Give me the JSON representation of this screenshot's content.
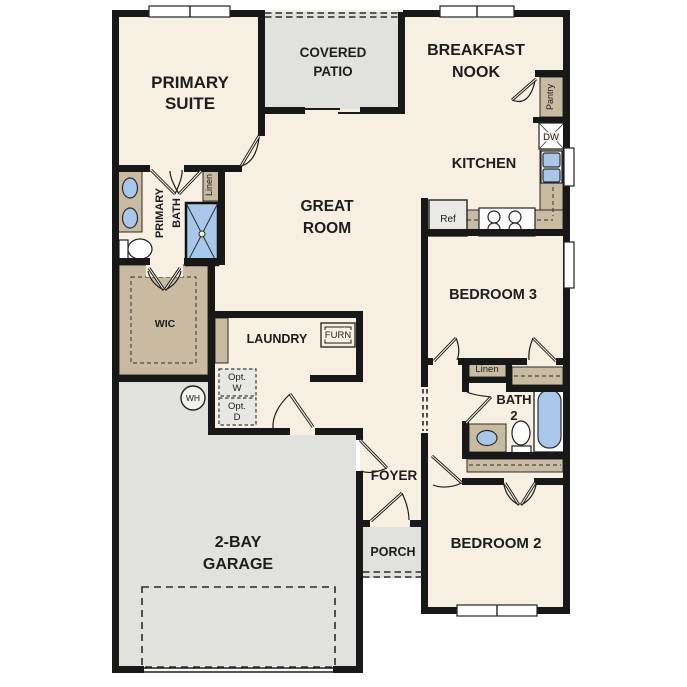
{
  "rooms": {
    "primary_suite": {
      "line1": "PRIMARY",
      "line2": "SUITE"
    },
    "covered_patio": {
      "line1": "COVERED",
      "line2": "PATIO"
    },
    "breakfast_nook": {
      "line1": "BREAKFAST",
      "line2": "NOOK"
    },
    "kitchen": {
      "label": "KITCHEN"
    },
    "great_room": {
      "line1": "GREAT",
      "line2": "ROOM"
    },
    "primary_bath": {
      "line1": "PRIMARY",
      "line2": "BATH"
    },
    "wic": {
      "label": "WIC"
    },
    "laundry": {
      "label": "LAUNDRY"
    },
    "bedroom3": {
      "label": "BEDROOM 3"
    },
    "bath2": {
      "line1": "BATH",
      "line2": "2"
    },
    "bedroom2": {
      "label": "BEDROOM 2"
    },
    "foyer": {
      "label": "FOYER"
    },
    "porch": {
      "label": "PORCH"
    },
    "garage": {
      "line1": "2-BAY",
      "line2": "GARAGE"
    }
  },
  "features": {
    "linen_primary": "Linen",
    "linen_hall": "Linen",
    "pantry": "Pantry",
    "dishwasher": "DW",
    "refrigerator": "Ref",
    "furnace": "FURN",
    "optional_washer": {
      "line1": "Opt.",
      "line2": "W"
    },
    "optional_dryer": {
      "line1": "Opt.",
      "line2": "D"
    },
    "water_heater": "WH"
  },
  "colors": {
    "wall": "#181818",
    "interior_floor": "#f7efe1",
    "outdoor_concrete": "#e1e1de",
    "cabinetry_tan": "#c9bba2",
    "plumbing_fixture_blue": "#a9c8e9",
    "optional_item_fill": "#e7e7e4"
  }
}
